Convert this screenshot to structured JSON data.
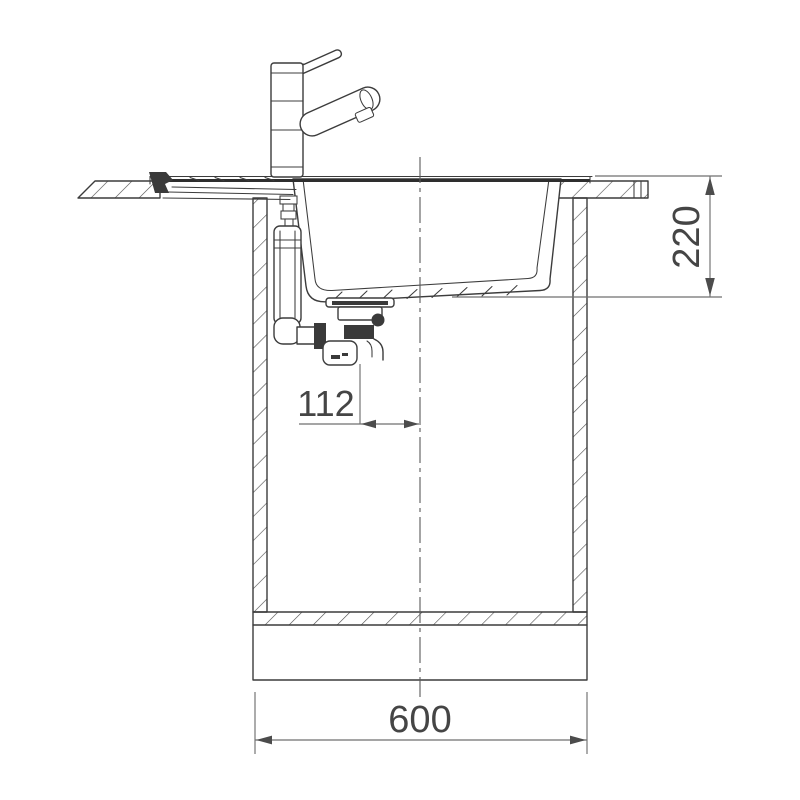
{
  "drawing": {
    "subject": "kitchen-sink-and-tap-installation-cross-section",
    "dimension_labels": {
      "basin_depth": "220",
      "drain_offset": "112",
      "cabinet_width": "600"
    },
    "colors": {
      "line": "#3c3c3c",
      "dimension_line": "#6f6f6f",
      "dimension_text": "#454545",
      "background": "#ffffff"
    }
  }
}
